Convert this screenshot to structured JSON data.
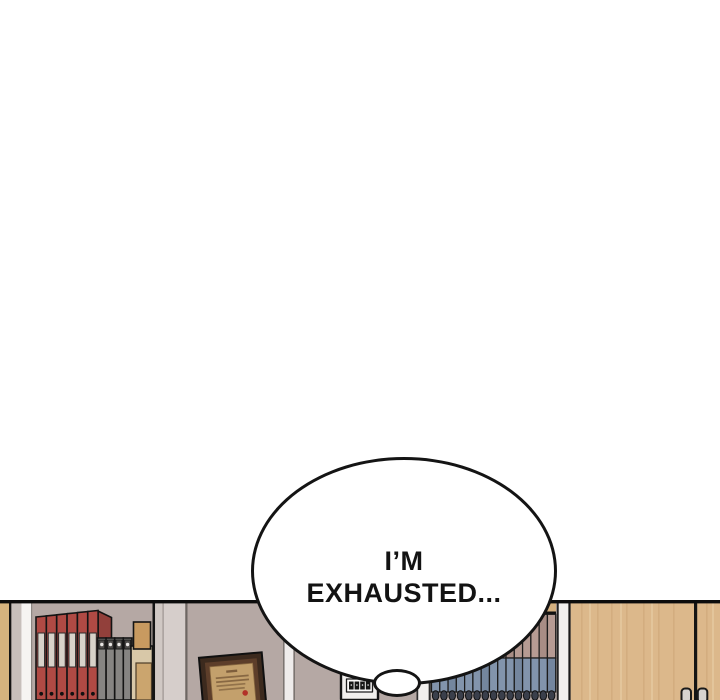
{
  "speech_bubble": {
    "line1": "I’M",
    "line2": "EXHAUSTED..."
  },
  "colors": {
    "outline": "#141414",
    "white": "#ffffff",
    "wall": "#b5a8a4",
    "wall_trim": "#efeceb",
    "side_tan": "#d5b37e",
    "left_strip_gray": "#c7bfbb",
    "left_strip_white": "#f6f4f2",
    "inner_trim_light": "#d6cecb",
    "shelf_board": "#d5b07f",
    "red_book": "#b04a44",
    "red_book_dark": "#92403b",
    "book_label": "#d8d2c9",
    "gray_book": "#868482",
    "gray_book_cap": "#4e4c4a",
    "tan_book": "#c89a60",
    "tan_box": "#d8c8a8",
    "tan_box2": "#cba56e",
    "pink_book": "#b69b93",
    "pink_book_dark": "#a88d85",
    "blue_book": "#8294ac",
    "blue_book_dark": "#74869e",
    "book_bump": "#3a3f4b",
    "cabinet_wood": "#dcb88b",
    "wood_grain": "#c9a172",
    "wood_grain_light": "#e9cfa6",
    "frame_brown": "#3c2a1e",
    "frame_inner": "#5d3e2a",
    "paper_gold": "#c3a06c",
    "paper_line": "#7e5e3c",
    "seal_red": "#b23228",
    "sign_white": "#f1efed"
  },
  "scene": {
    "red_books": {
      "count": 6,
      "x": 36,
      "width": 10.35,
      "top": 17
    },
    "gray_books": {
      "count": 4,
      "x": 97.5,
      "width": 8.6,
      "top": 38
    },
    "right_books": {
      "count": 15,
      "x": 431.5,
      "width": 8.28,
      "top": 14.3,
      "split": 58
    }
  }
}
